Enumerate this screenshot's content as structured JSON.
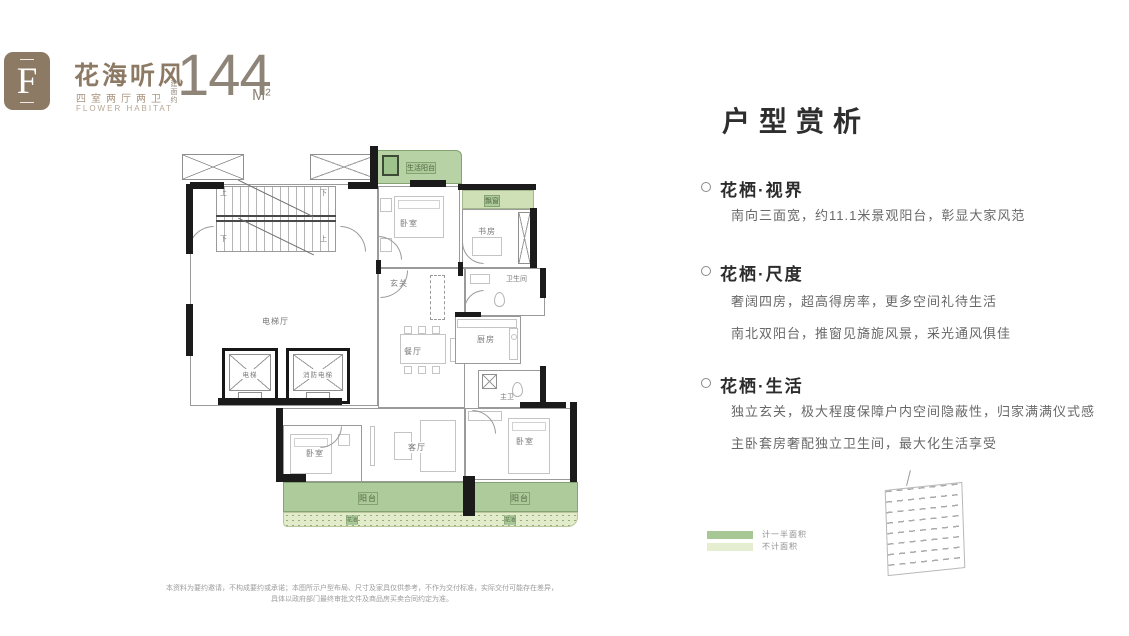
{
  "header": {
    "badge_letter": "F",
    "title": "花海听风",
    "subtitle": "四室两厅两卫",
    "subtitle_en": "FLOWER HABITAT",
    "area_label": "建面约",
    "area_value": "144",
    "area_unit": "M²",
    "brand_color": "#8d7a65"
  },
  "plan": {
    "labels": {
      "life_balcony": "生活阳台",
      "bedroom_top": "卧室",
      "bay_window": "飘窗",
      "study": "书房",
      "foyer": "玄关",
      "bathroom": "卫生间",
      "kitchen": "厨房",
      "master_bath": "主卫",
      "elevator_hall": "电梯厅",
      "elevator": "电梯",
      "fire_elevator": "消防电梯",
      "dining": "餐厅",
      "living": "客厅",
      "bedroom_left": "卧室",
      "bedroom_right": "卧室",
      "balcony_left": "阳台",
      "balcony_right": "阳台",
      "flower_bed": "花池",
      "up": "上",
      "down": "下"
    }
  },
  "analysis": {
    "title": "户型赏析",
    "sections": [
      {
        "heading": "花栖·视界",
        "lines": [
          "南向三面宽，约11.1米景观阳台，彰显大家风范"
        ]
      },
      {
        "heading": "花栖·尺度",
        "lines": [
          "奢阔四房，超高得房率，更多空间礼待生活",
          "南北双阳台，推窗见旖旎风景，采光通风俱佳"
        ]
      },
      {
        "heading": "花栖·生活",
        "lines": [
          "独立玄关，极大程度保障户内空间隐蔽性，归家满满仪式感",
          "主卧套房奢配独立卫生间，最大化生活享受"
        ]
      }
    ]
  },
  "legend": {
    "items": [
      {
        "label": "计一半面积",
        "color": "#a7c795"
      },
      {
        "label": "不计面积",
        "color": "#e6eed2"
      }
    ]
  },
  "disclaimer": {
    "line1": "本资料为要约邀请，不构成要约或承诺；本图所示户型布局、尺寸及家具仅供参考，不作为交付标准，实际交付可能存在差异，",
    "line2": "具体以政府部门最终审批文件及商品房买卖合同约定为准。"
  }
}
